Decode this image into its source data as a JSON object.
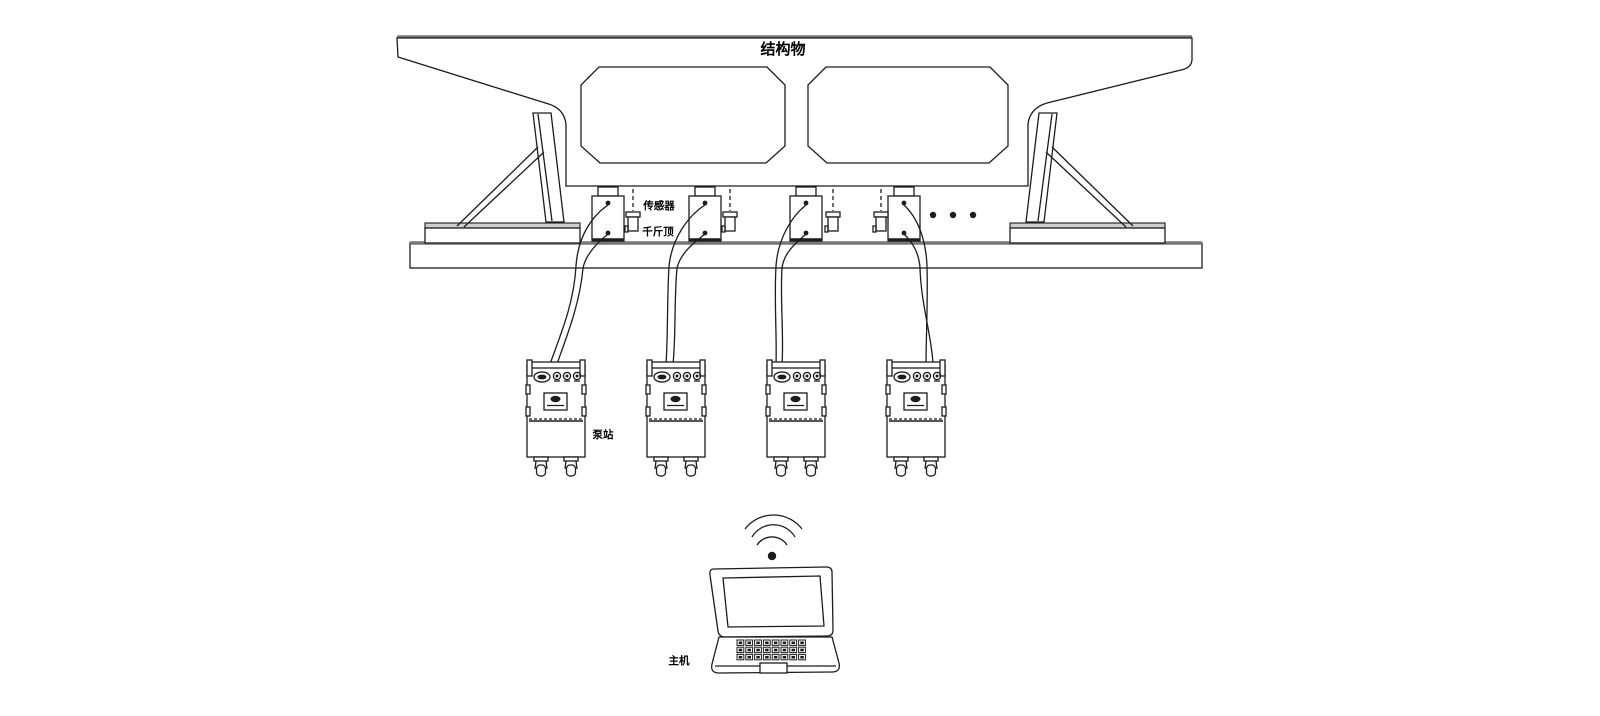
{
  "diagram": {
    "background": "#ffffff",
    "line_color": "#1c1c1c",
    "labels": {
      "structure": "结构物",
      "sensor": "传感器",
      "jack": "千斤顶",
      "pump_station": "泵站",
      "host": "主机"
    },
    "counts": {
      "jacks": 4,
      "sensors": 4,
      "pump_stations": 4,
      "supports": 2,
      "girder_voids": 2,
      "wireless_arcs": 3,
      "continuation_dots": 3
    },
    "icons": {
      "wireless": "wifi-signal-icon",
      "host_device": "laptop",
      "continuation": "ellipsis-dots"
    }
  }
}
